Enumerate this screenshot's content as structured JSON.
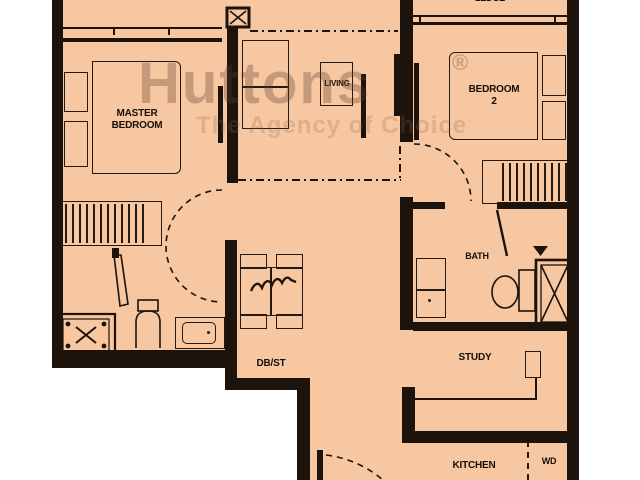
{
  "colors": {
    "floor": "#f6c7a0",
    "wall": "#1c130c",
    "line": "#241a12",
    "wm-dark": "rgba(96,64,48,0.33)",
    "wm-mid": "rgba(120,90,70,0.38)",
    "wm-light": "rgba(150,100,75,0.24)"
  },
  "watermark": {
    "brand": "Huttons",
    "registered": "®",
    "tagline": "The Agency of Choice"
  },
  "rooms": {
    "ledge": {
      "label": "LEDGE"
    },
    "master_bedroom": {
      "label": "MASTER\nBEDROOM"
    },
    "living": {
      "label": "LIVING"
    },
    "bedroom_2": {
      "label": "BEDROOM\n2"
    },
    "bath": {
      "label": "BATH"
    },
    "study": {
      "label": "STUDY"
    },
    "kitchen": {
      "label": "KITCHEN"
    },
    "wd": {
      "label": "WD"
    },
    "db_st": {
      "label": "DB/ST"
    }
  }
}
